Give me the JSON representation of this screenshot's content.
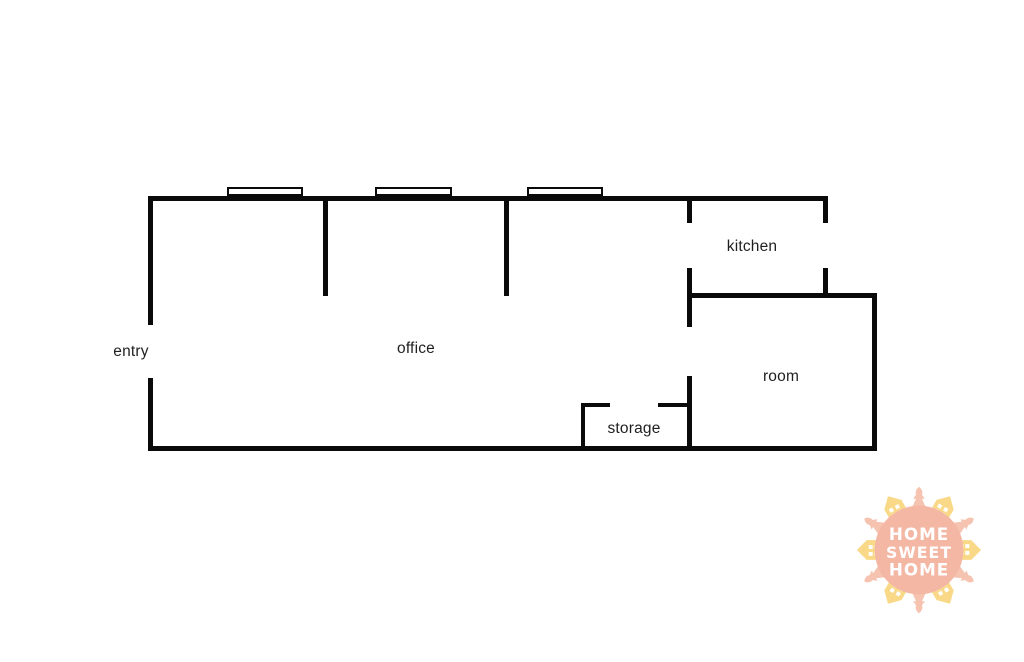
{
  "floorplan": {
    "wall_color": "#0a0a0a",
    "label_color": "#1f1f1f",
    "rooms": [
      {
        "id": "entry",
        "label": "entry",
        "x": 131,
        "y": 352
      },
      {
        "id": "office",
        "label": "office",
        "x": 416,
        "y": 349
      },
      {
        "id": "kitchen",
        "label": "kitchen",
        "x": 752,
        "y": 247
      },
      {
        "id": "storage",
        "label": "storage",
        "x": 634,
        "y": 429
      },
      {
        "id": "room",
        "label": "room",
        "x": 781,
        "y": 377
      }
    ],
    "walls": [
      {
        "x": 148,
        "y": 196,
        "w": 680,
        "h": 5
      },
      {
        "x": 148,
        "y": 196,
        "w": 5,
        "h": 129
      },
      {
        "x": 148,
        "y": 378,
        "w": 5,
        "h": 73
      },
      {
        "x": 148,
        "y": 446,
        "w": 729,
        "h": 5
      },
      {
        "x": 323,
        "y": 196,
        "w": 5,
        "h": 100
      },
      {
        "x": 504,
        "y": 196,
        "w": 5,
        "h": 100
      },
      {
        "x": 687,
        "y": 196,
        "w": 5,
        "h": 27
      },
      {
        "x": 687,
        "y": 268,
        "w": 5,
        "h": 59
      },
      {
        "x": 687,
        "y": 376,
        "w": 5,
        "h": 75
      },
      {
        "x": 823,
        "y": 196,
        "w": 5,
        "h": 27
      },
      {
        "x": 823,
        "y": 268,
        "w": 5,
        "h": 30
      },
      {
        "x": 687,
        "y": 293,
        "w": 190,
        "h": 5
      },
      {
        "x": 872,
        "y": 293,
        "w": 5,
        "h": 158
      },
      {
        "x": 581,
        "y": 403,
        "w": 29,
        "h": 4
      },
      {
        "x": 658,
        "y": 403,
        "w": 33,
        "h": 4
      },
      {
        "x": 581,
        "y": 403,
        "w": 4,
        "h": 48
      }
    ],
    "windows": [
      {
        "x": 227,
        "y": 187,
        "w": 76,
        "h": 9
      },
      {
        "x": 375,
        "y": 187,
        "w": 77,
        "h": 9
      },
      {
        "x": 527,
        "y": 187,
        "w": 76,
        "h": 9
      }
    ]
  },
  "logo": {
    "lines": [
      "HOME",
      "SWEET",
      "HOME"
    ],
    "circle_color": "#f3b7a4",
    "house_color": "#f9d987",
    "tree_color": "#f5c3af",
    "text_color": "#ffffff"
  }
}
